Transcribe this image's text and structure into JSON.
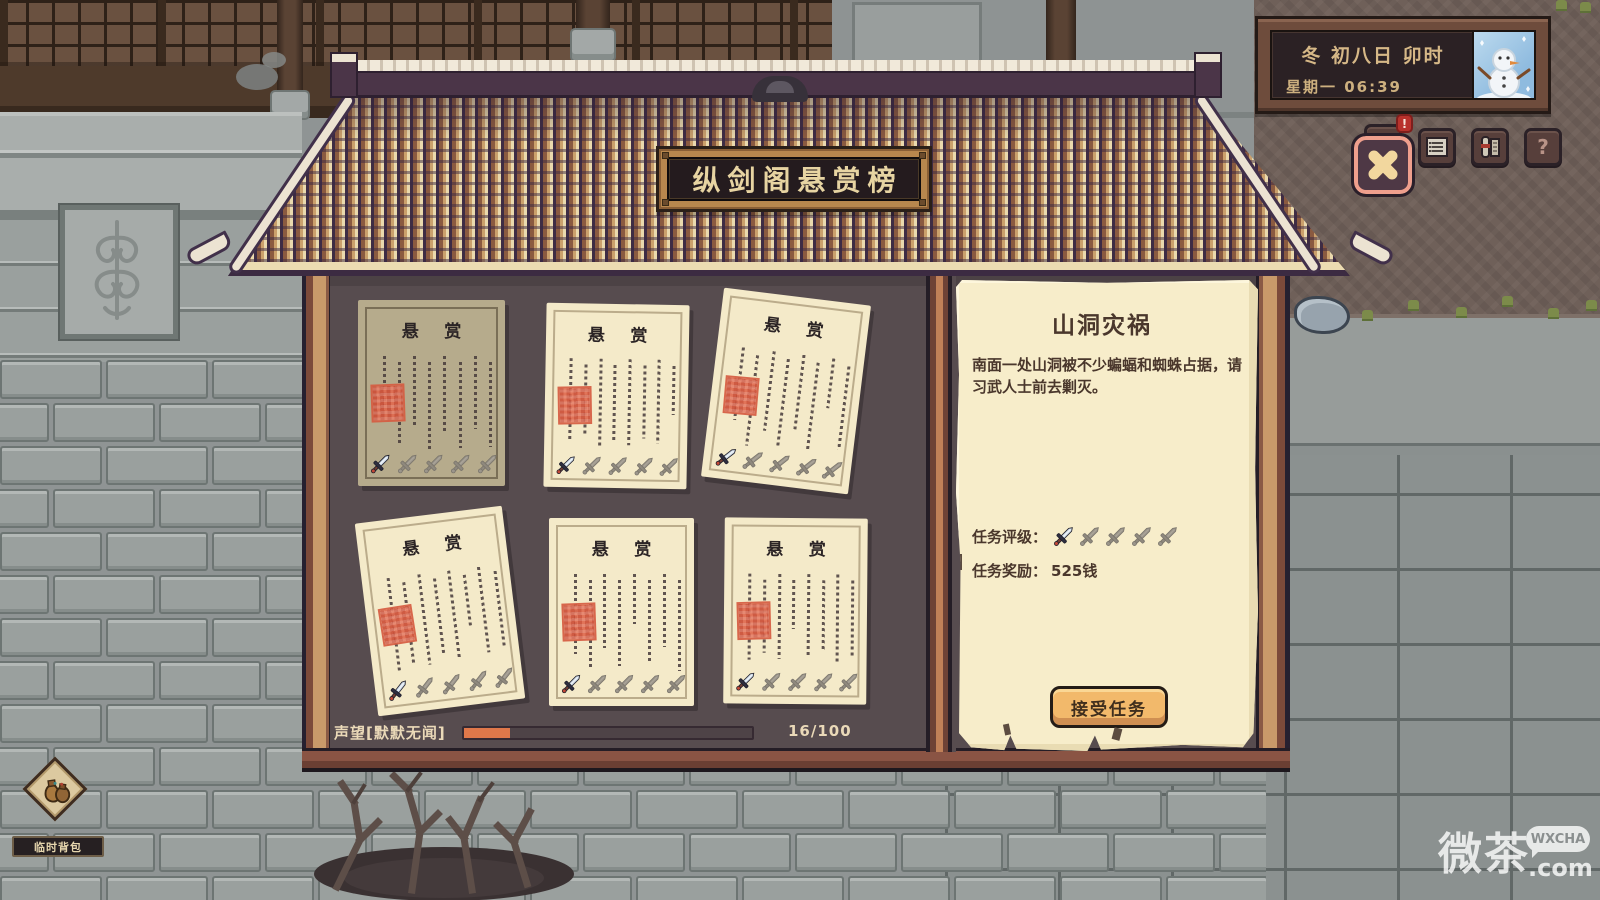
{
  "scene": {
    "name": "bounty-board-screen"
  },
  "datetime": {
    "line1": "冬 初八日 卯时",
    "line2": "星期一 06:39"
  },
  "topbar": {
    "buttons": [
      {
        "id": "messages",
        "icon": "mail-icon",
        "badge": "!"
      },
      {
        "id": "journal",
        "icon": "journal-icon"
      },
      {
        "id": "scrolls",
        "icon": "scroll-icon"
      },
      {
        "id": "help",
        "icon": "help-icon",
        "glyph": "?"
      }
    ]
  },
  "board": {
    "sign": "纵剑阁悬赏榜",
    "posters": [
      {
        "title": "悬赏",
        "rating": 1,
        "rating_max": 5,
        "highlighted": true
      },
      {
        "title": "悬赏",
        "rating": 1,
        "rating_max": 5,
        "highlighted": false
      },
      {
        "title": "悬赏",
        "rating": 1,
        "rating_max": 5,
        "highlighted": false
      },
      {
        "title": "悬赏",
        "rating": 1,
        "rating_max": 5,
        "highlighted": false
      },
      {
        "title": "悬赏",
        "rating": 1,
        "rating_max": 5,
        "highlighted": false
      },
      {
        "title": "悬赏",
        "rating": 1,
        "rating_max": 5,
        "highlighted": false
      }
    ],
    "reputation": {
      "label": "声望[默默无闻]",
      "value": 16,
      "max": 100,
      "display": "16/100"
    }
  },
  "quest": {
    "title": "山洞灾祸",
    "description": "南面一处山洞被不少蝙蝠和蜘蛛占据，请习武人士前去剿灭。",
    "rating_label": "任务评级：",
    "rating": 1,
    "rating_max": 5,
    "reward_label": "任务奖励：",
    "reward": "525钱",
    "accept_label": "接受任务"
  },
  "hud": {
    "backpack_label": "临时背包"
  },
  "watermark": {
    "brand": "微茶",
    "bubble": "WXCHA",
    "suffix": ".com"
  },
  "colors": {
    "accent_orange": "#e0784a",
    "paper": "#f7edca",
    "board_bg": "#574c4f",
    "button_orange": "#f2b96b",
    "seal_red": "#cc4f38",
    "gold_text": "#e7d4a2",
    "frame_brown": "#7c4a3a",
    "frame_tan": "#c99a6a"
  }
}
